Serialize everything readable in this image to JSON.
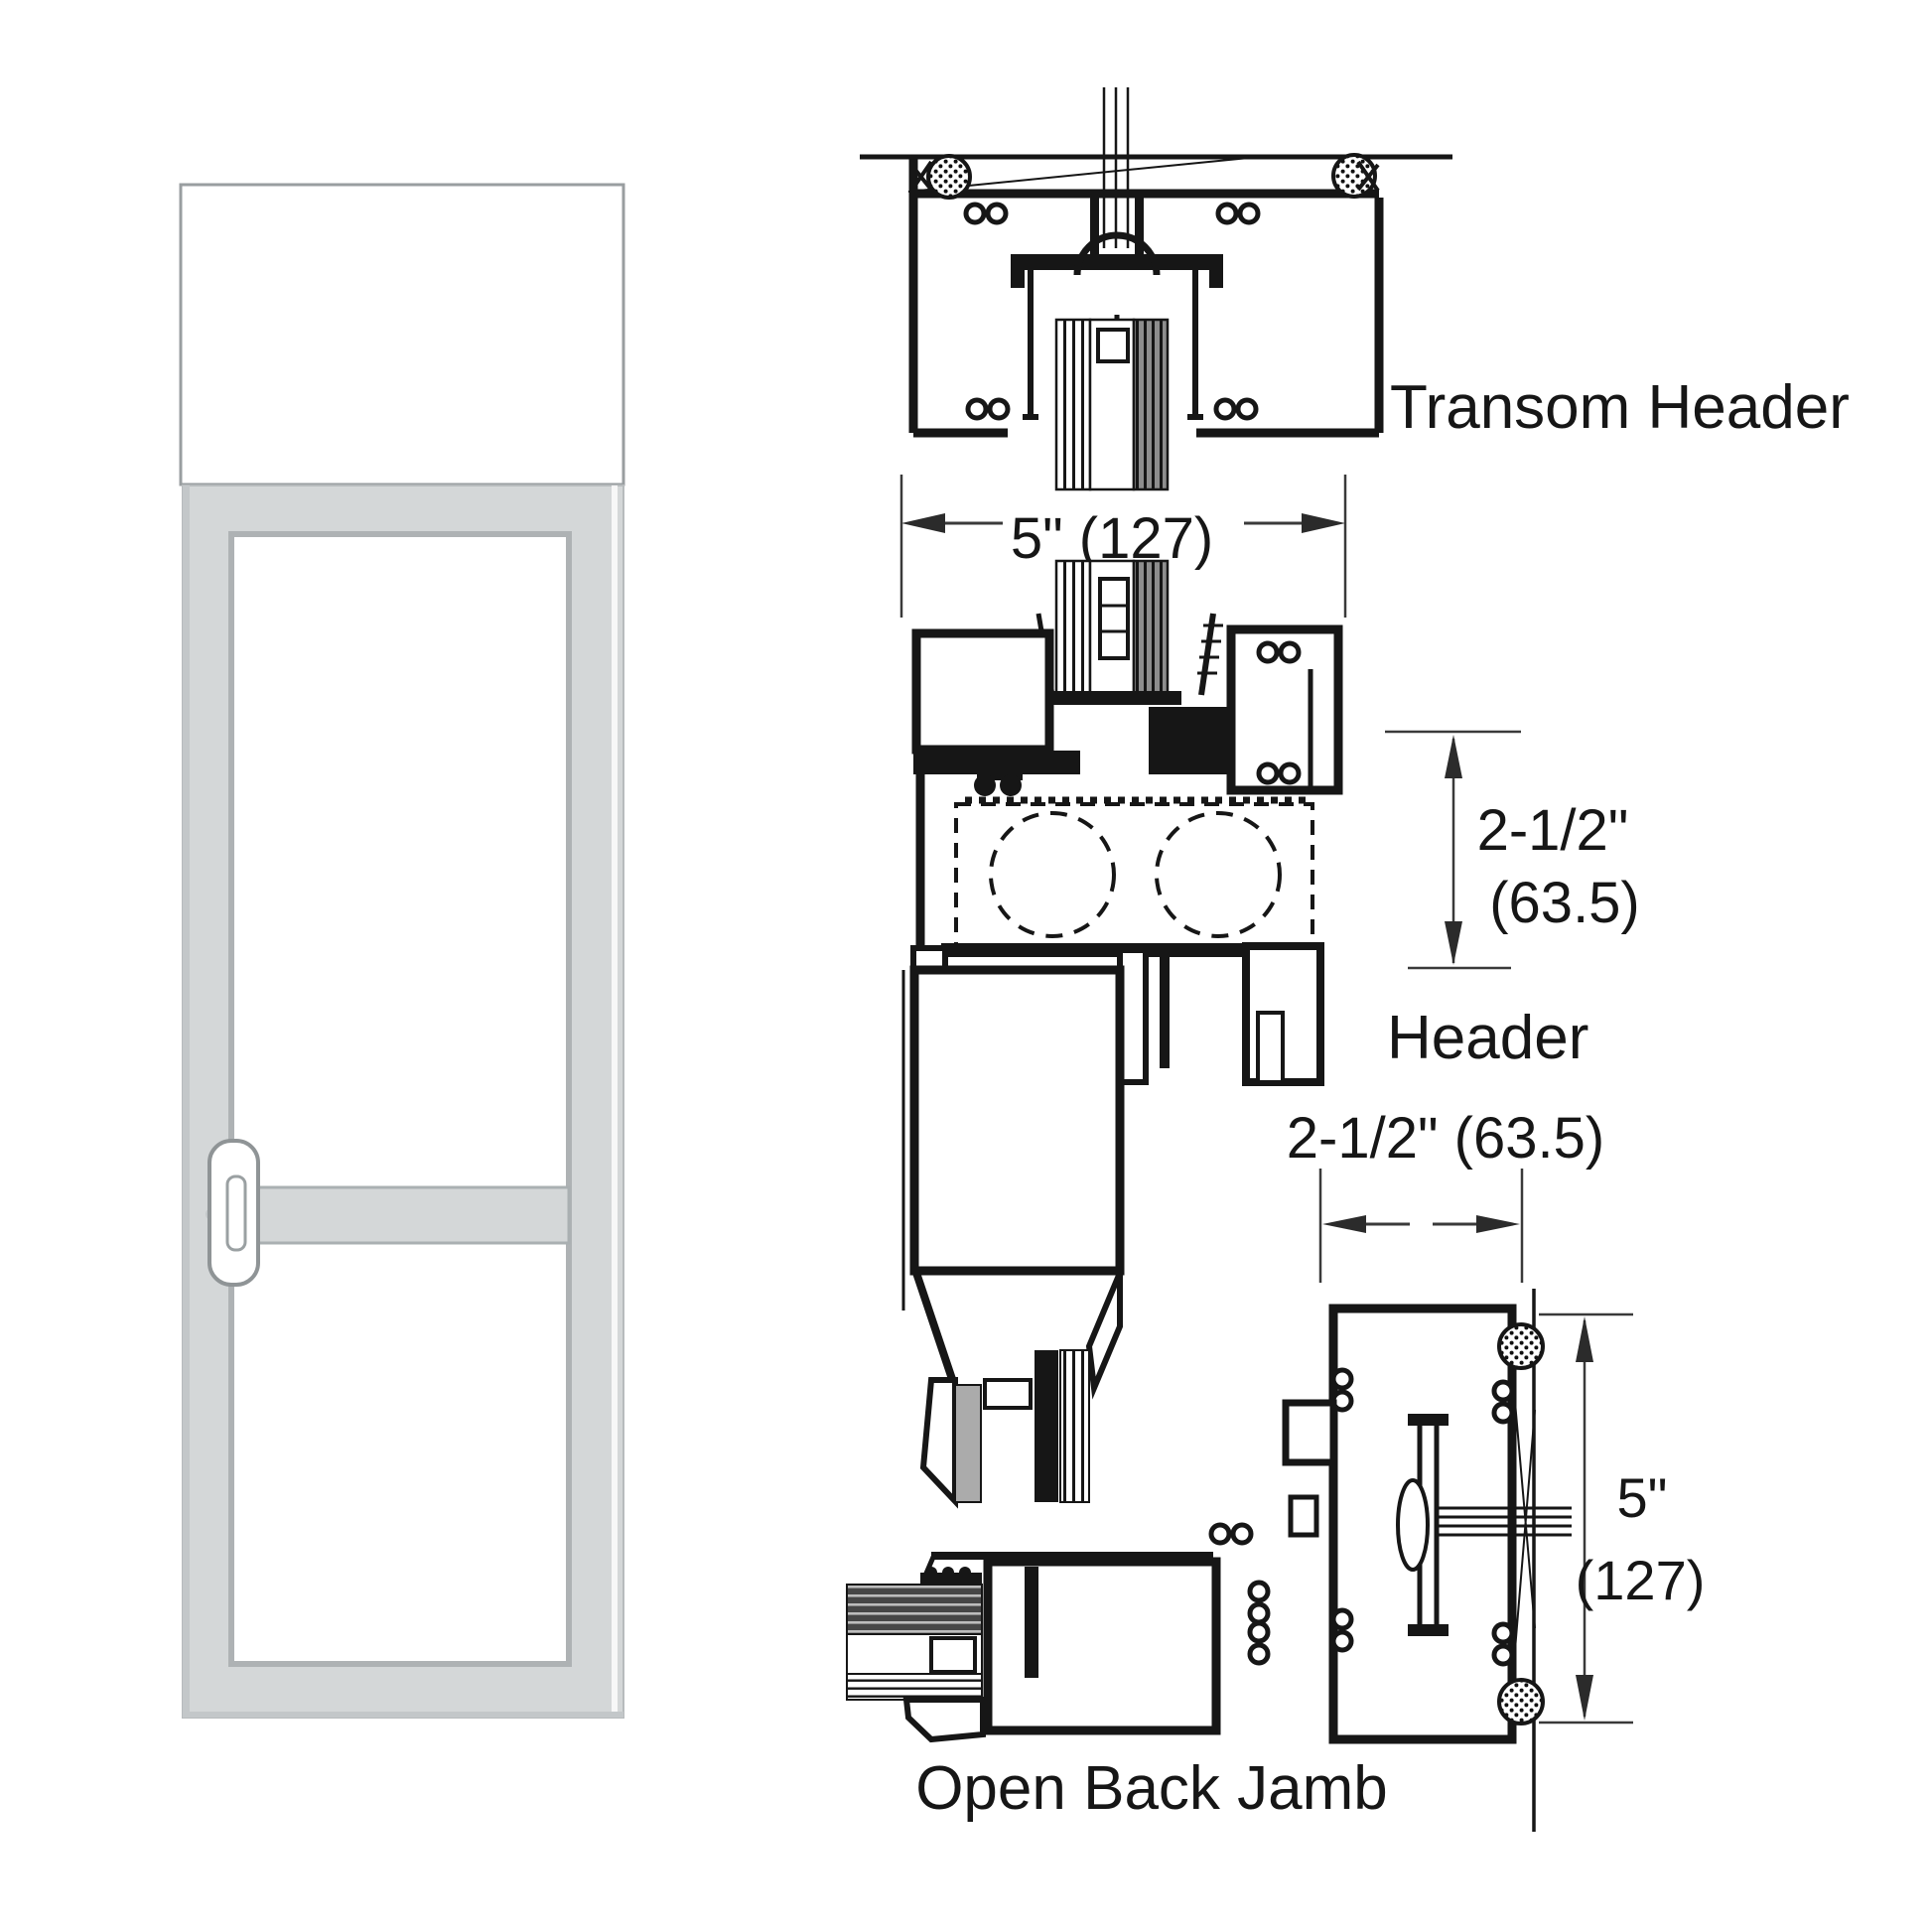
{
  "labels": {
    "transom_header": "Transom Header",
    "header": "Header",
    "open_back_jamb": "Open Back Jamb"
  },
  "dimensions": {
    "transom_frame_width": "5\" (127)",
    "header_height_top": "2-1/2\"",
    "header_height_bottom": "(63.5)",
    "jamb_depth": "2-1/2\" (63.5)",
    "jamb_height_top": "5\"",
    "jamb_height_bottom": "(127)"
  },
  "colors": {
    "line": "#161616",
    "dim_line": "#3a3a3a",
    "door_frame": "#d4d7d8",
    "door_frame_edge": "#c3c7c9",
    "glass": "#ffffff",
    "glass_border": "#aeb2b4",
    "transom_border": "#999ea0",
    "handle_outline": "#8f9496",
    "lock_dot": "#c4c8ca",
    "vinyl": "#ababab"
  }
}
